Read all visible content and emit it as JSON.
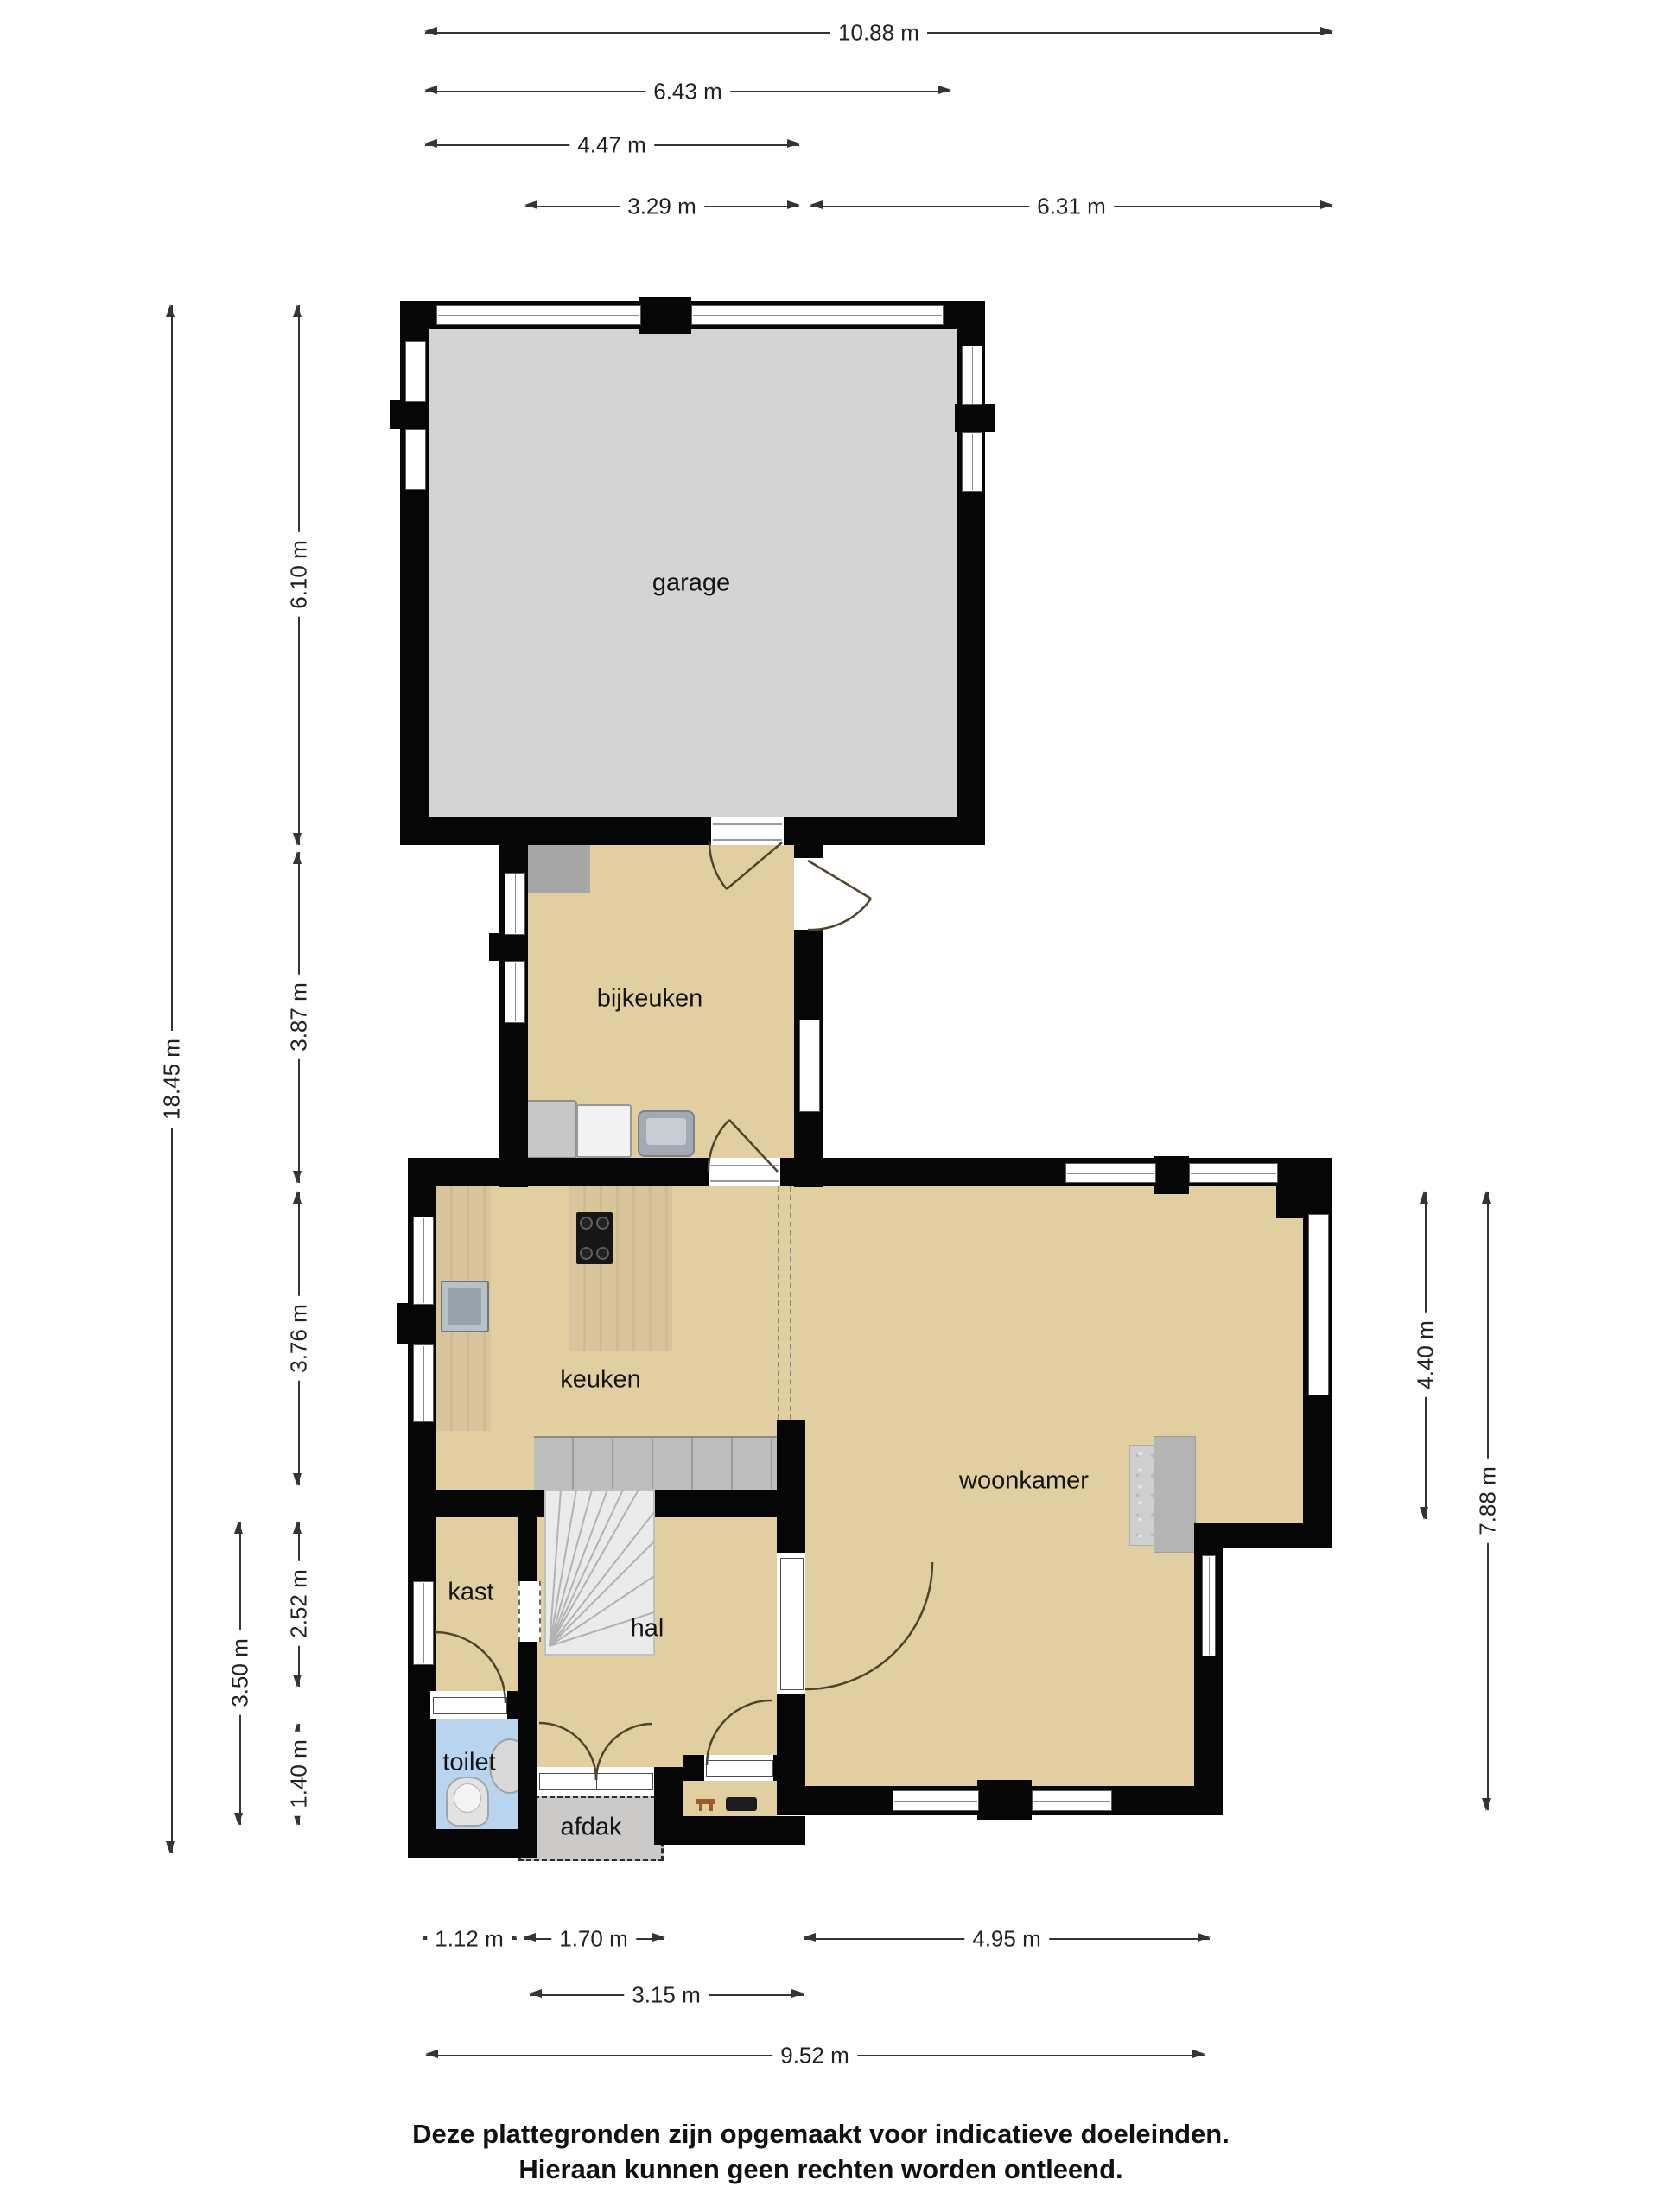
{
  "rooms": {
    "garage": "garage",
    "bijkeuken": "bijkeuken",
    "keuken": "keuken",
    "woonkamer": "woonkamer",
    "kast": "kast",
    "hal": "hal",
    "toilet": "toilet",
    "afdak": "afdak"
  },
  "dimensions": {
    "top": [
      "10.88 m",
      "6.43 m",
      "4.47 m",
      "3.29 m",
      "6.31 m"
    ],
    "left": [
      "18.45 m",
      "6.10 m",
      "3.87 m",
      "3.76 m",
      "2.52 m",
      "1.40 m",
      "3.50 m"
    ],
    "right": [
      "4.40 m",
      "7.88 m"
    ],
    "bottom": [
      "1.12 m",
      "1.70 m",
      "4.95 m",
      "3.15 m",
      "9.52 m"
    ]
  },
  "footer": {
    "line1": "Deze plattegronden zijn opgemaakt voor indicatieve doeleinden.",
    "line2": "Hieraan kunnen geen rechten worden ontleend."
  },
  "colors": {
    "wall": "#060606",
    "floor_garage": "#d4d4d4",
    "floor_living": "#e2cfa1",
    "floor_toilet": "#b9d4ee",
    "afdak": "#cbcac8",
    "dimension_line": "#343434"
  }
}
